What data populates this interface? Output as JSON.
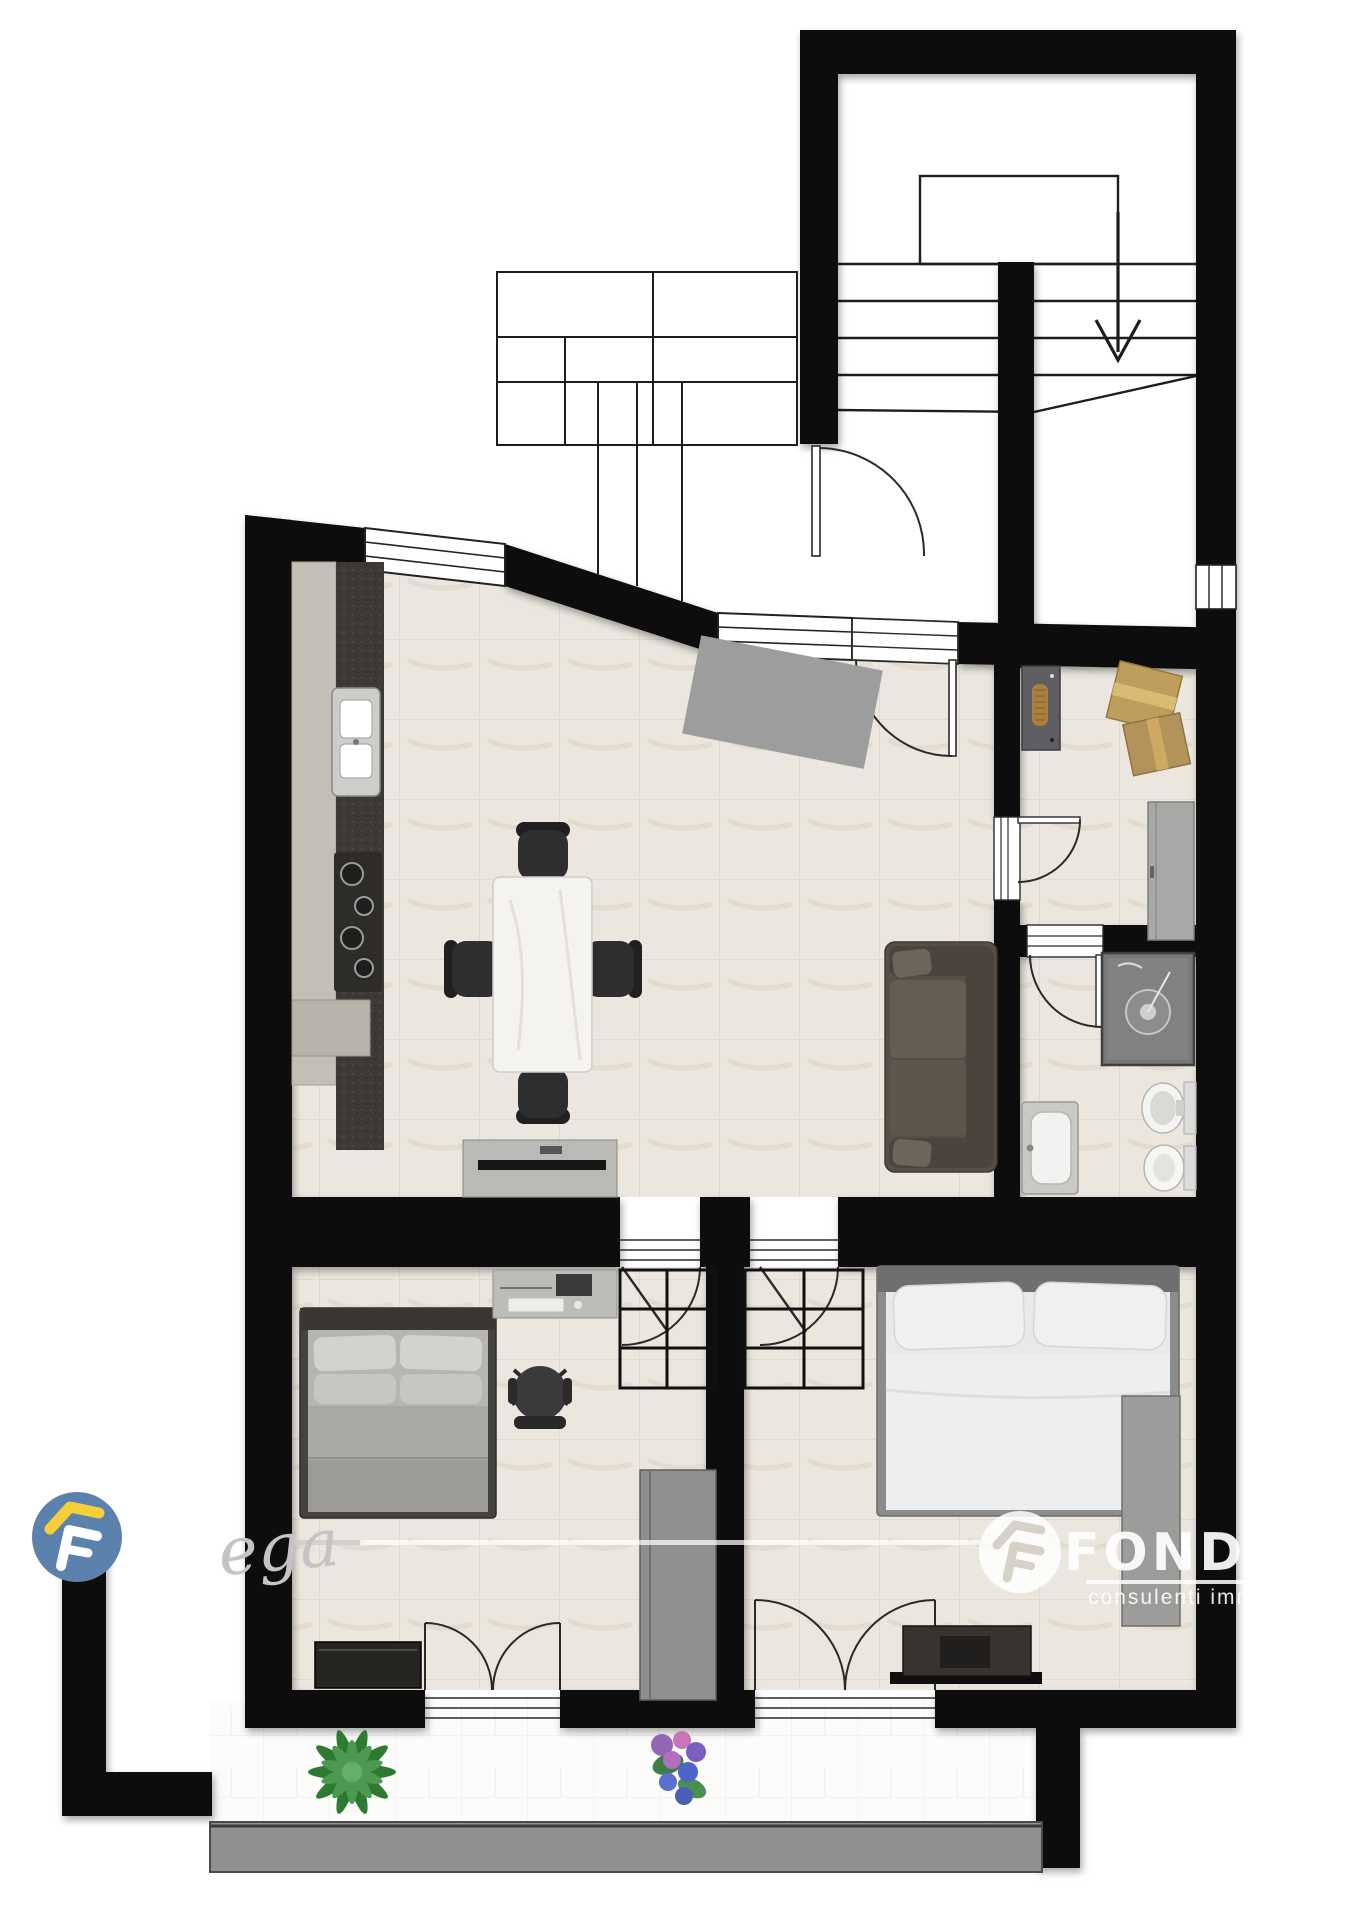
{
  "title": "apartment-floor-plan",
  "watermarks": {
    "script_signature": "ega",
    "brand_logo_text": "FONDOCAS",
    "brand_tagline": "consulenti imm"
  },
  "colors": {
    "wall": "#0b0b0b",
    "interior_floor": "#ebe7df",
    "balcony_floor": "#fcfcfa",
    "kitchen_counter_dark": "#3c3936",
    "kitchen_cabinet_light": "#c2bfb7",
    "sofa": "#564f47",
    "logo_blue": "#5b81ad",
    "logo_yellow": "#f4cf3a",
    "watermark_white": "rgba(255,255,255,0.85)"
  },
  "symbols": [
    "staircase-with-down-arrow",
    "entrance-door",
    "kitchen-sink",
    "cooktop",
    "dining-table",
    "dining-chairs",
    "doormat",
    "sofa",
    "tv-sideboard",
    "electrical-panel",
    "moving-boxes",
    "hall-cabinet",
    "shower",
    "washbasin",
    "toilet",
    "bidet",
    "double-bed-gray",
    "double-bed-white",
    "desk-with-computer",
    "office-chair",
    "wardrobe",
    "dresser",
    "closet-grid",
    "french-doors",
    "balcony-plant",
    "balcony-flowers",
    "parapet"
  ]
}
